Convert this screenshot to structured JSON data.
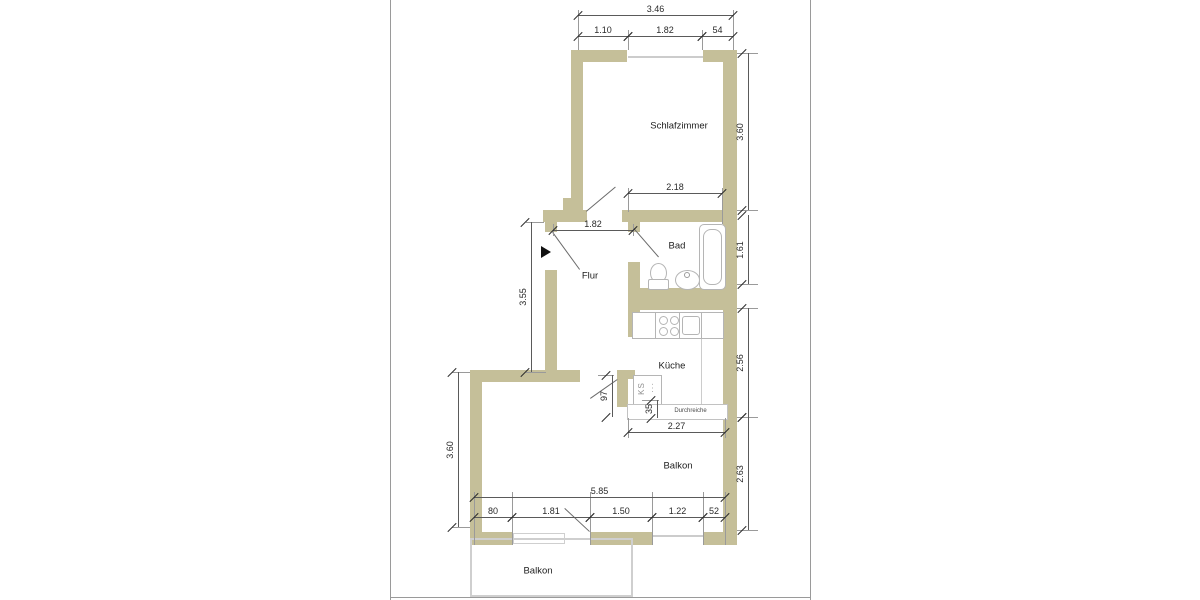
{
  "document_type": "floor-plan",
  "colors": {
    "wall_fill": "#c5bf99",
    "dimension_line": "#5a5a5a",
    "extension_line": "#9a9a9a",
    "text": "#2a2a2a",
    "fixture_outline": "#b5b5b5",
    "page_border": "#9a9a9a",
    "entrance_arrow": "#111111"
  },
  "rooms": [
    {
      "label": "Schlafzimmer",
      "x": 679,
      "y": 126
    },
    {
      "label": "Bad",
      "x": 677,
      "y": 246
    },
    {
      "label": "Flur",
      "x": 590,
      "y": 276
    },
    {
      "label": "Küche",
      "x": 672,
      "y": 366
    },
    {
      "label": "Balkon",
      "x": 678,
      "y": 466
    },
    {
      "label": "Balkon",
      "x": 538,
      "y": 571
    }
  ],
  "annotations": {
    "ks": "KS",
    "ks_dots": "···",
    "pass": "Durchreiche"
  },
  "dimensions": {
    "horizontal": [
      {
        "label": "3.46",
        "x": 578,
        "y": 15,
        "len": 155
      },
      {
        "label": "1.10",
        "x": 578,
        "y": 36,
        "len": 50
      },
      {
        "label": "1.82",
        "x": 628,
        "y": 36,
        "len": 74
      },
      {
        "label": "54",
        "x": 702,
        "y": 36,
        "len": 31
      },
      {
        "label": "2.18",
        "x": 628,
        "y": 193,
        "len": 94
      },
      {
        "label": "1.82",
        "x": 553,
        "y": 230,
        "len": 80
      },
      {
        "label": "2.27",
        "x": 628,
        "y": 432,
        "len": 97
      },
      {
        "label": "5.85",
        "x": 474,
        "y": 497,
        "len": 251
      },
      {
        "label": "80",
        "x": 474,
        "y": 517,
        "len": 38
      },
      {
        "label": "1.81",
        "x": 512,
        "y": 517,
        "len": 78
      },
      {
        "label": "1.50",
        "x": 590,
        "y": 517,
        "len": 62
      },
      {
        "label": "1.22",
        "x": 652,
        "y": 517,
        "len": 51
      },
      {
        "label": "52",
        "x": 703,
        "y": 517,
        "len": 22
      }
    ],
    "vertical": [
      {
        "label": "3.55",
        "x": 531,
        "y": 222,
        "len": 150
      },
      {
        "label": "3.60",
        "x": 458,
        "y": 372,
        "len": 155
      },
      {
        "label": "97",
        "x": 612,
        "y": 375,
        "len": 42
      },
      {
        "label": "35",
        "x": 657,
        "y": 400,
        "len": 18
      },
      {
        "label": "3.60",
        "x": 748,
        "y": 53,
        "len": 157
      },
      {
        "label": "1.61",
        "x": 748,
        "y": 215,
        "len": 69
      },
      {
        "label": "2.56",
        "x": 748,
        "y": 308,
        "len": 109
      },
      {
        "label": "2.63",
        "x": 748,
        "y": 417,
        "len": 113
      }
    ]
  },
  "walls": [
    [
      571,
      50,
      56,
      12
    ],
    [
      703,
      50,
      32,
      12
    ],
    [
      571,
      50,
      12,
      162
    ],
    [
      723,
      50,
      14,
      495
    ],
    [
      563,
      198,
      14,
      13
    ],
    [
      543,
      210,
      44,
      12
    ],
    [
      622,
      210,
      115,
      12
    ],
    [
      545,
      210,
      12,
      22
    ],
    [
      545,
      270,
      12,
      102
    ],
    [
      628,
      222,
      12,
      10
    ],
    [
      628,
      262,
      12,
      75
    ],
    [
      630,
      288,
      107,
      22
    ],
    [
      470,
      370,
      110,
      12
    ],
    [
      470,
      378,
      12,
      167
    ],
    [
      470,
      532,
      42,
      13
    ],
    [
      590,
      532,
      63,
      13
    ],
    [
      703,
      532,
      34,
      13
    ],
    [
      617,
      370,
      18,
      9
    ],
    [
      617,
      379,
      11,
      28
    ]
  ],
  "extension_lines": [
    [
      578,
      10,
      1,
      40
    ],
    [
      628,
      30,
      1,
      20
    ],
    [
      702,
      30,
      1,
      20
    ],
    [
      733,
      10,
      1,
      40
    ],
    [
      628,
      188,
      1,
      24
    ],
    [
      722,
      188,
      1,
      36
    ],
    [
      553,
      224,
      1,
      12
    ],
    [
      633,
      224,
      1,
      12
    ],
    [
      628,
      418,
      1,
      20
    ],
    [
      725,
      418,
      1,
      20
    ],
    [
      474,
      492,
      1,
      53
    ],
    [
      512,
      492,
      1,
      53
    ],
    [
      590,
      492,
      1,
      53
    ],
    [
      652,
      492,
      1,
      53
    ],
    [
      703,
      492,
      1,
      53
    ],
    [
      725,
      492,
      1,
      53
    ],
    [
      526,
      222,
      18,
      1
    ],
    [
      526,
      372,
      20,
      1
    ],
    [
      452,
      372,
      18,
      1
    ],
    [
      452,
      527,
      18,
      1
    ],
    [
      737,
      53,
      21,
      1
    ],
    [
      737,
      210,
      21,
      1
    ],
    [
      737,
      284,
      21,
      1
    ],
    [
      737,
      308,
      21,
      1
    ],
    [
      737,
      417,
      21,
      1
    ],
    [
      737,
      530,
      21,
      1
    ],
    [
      598,
      375,
      16,
      1
    ],
    [
      642,
      400,
      17,
      1
    ]
  ],
  "door_swings": [
    [
      586,
      211,
      38,
      -40
    ],
    [
      553,
      232,
      46,
      54
    ],
    [
      634,
      228,
      38,
      49
    ],
    [
      590,
      398,
      33,
      -35
    ],
    [
      565,
      508,
      34,
      43
    ]
  ],
  "sills": [
    [
      628,
      56,
      75,
      2
    ],
    [
      653,
      535,
      50,
      2
    ]
  ],
  "door_sill_rect": [
    513,
    533,
    50,
    9
  ],
  "kitchen_divider": [
    701,
    337,
    1,
    67
  ],
  "fixtures": {
    "bathtub_outer": [
      699,
      224,
      25,
      64
    ],
    "bathtub_inner": [
      703,
      229,
      17,
      54
    ],
    "toilet_bowl": [
      650,
      263,
      15,
      18
    ],
    "toilet_base": [
      648,
      279,
      19,
      9
    ],
    "washbasin": [
      675,
      270,
      23,
      18
    ],
    "basin_dot": [
      684,
      272,
      4,
      4
    ],
    "counter": [
      632,
      312,
      24,
      25
    ],
    "stove": [
      655,
      312,
      25,
      25
    ],
    "burners": [
      [
        659,
        316
      ],
      [
        670,
        316
      ],
      [
        659,
        327
      ],
      [
        670,
        327
      ]
    ],
    "sink_outer": [
      679,
      312,
      23,
      25
    ],
    "sink_inner": [
      682,
      316,
      16,
      17
    ],
    "drainboard": [
      701,
      312,
      21,
      25
    ],
    "refrigerator": [
      633,
      375,
      27,
      28
    ],
    "pass_counter": [
      627,
      404,
      99,
      14
    ]
  },
  "balcony_outline": [
    470,
    538,
    159,
    55
  ],
  "entrance_arrow": {
    "x": 541,
    "y": 246
  },
  "page": {
    "left_x": 390,
    "right_x": 810,
    "bottom_y": 597,
    "bottom_x1": 390,
    "bottom_x2": 810
  }
}
